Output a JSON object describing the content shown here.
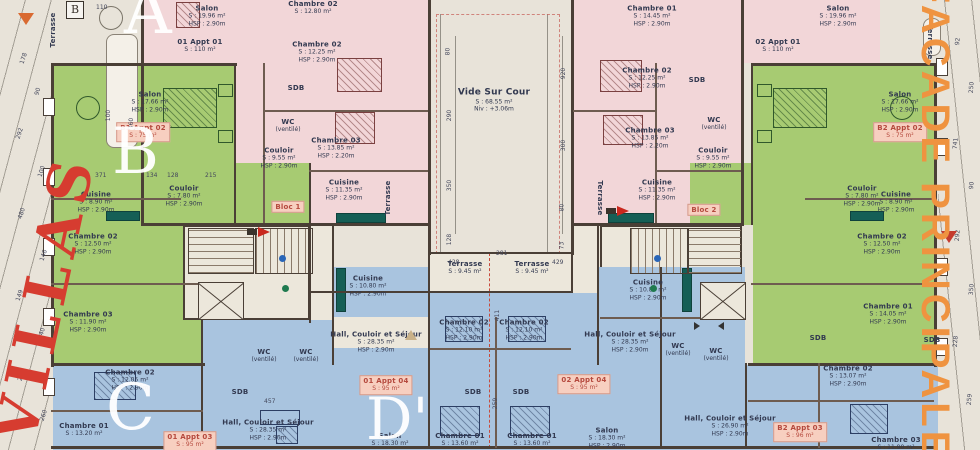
{
  "title": "Plan d'étage — Bloc 1 / Bloc 2",
  "margins": {
    "left_text": "VILLAS",
    "right_text": "FACADE PRINCIPALE",
    "corner_marker": "B"
  },
  "letters": {
    "a": "A",
    "b": "B",
    "c": "C",
    "d": "D'"
  },
  "colors": {
    "paper": "#e8e3d9",
    "pink_zone": "#f2d6d8",
    "green_zone": "#a7cb72",
    "blue_zone": "#a9c4df",
    "cream_zone": "#ece7db",
    "wall": "#4a3f36",
    "villas_red": "#d63c30",
    "facade_orange": "#ef9340",
    "apartment_label_bg": "#f7cfc0",
    "apartment_label_text": "#b5493d"
  },
  "rooms": [
    {
      "label": "Salon",
      "sub1": "S : 19.96 m²",
      "sub2": "HSP : 2.90m",
      "x": 207,
      "y": 16
    },
    {
      "label": "01 Appt 01",
      "sub1": "S : 110 m²",
      "x": 200,
      "y": 46
    },
    {
      "label": "Chambre 02",
      "sub1": "S : 12.80 m²",
      "x": 313,
      "y": 8
    },
    {
      "label": "Chambre 02",
      "sub1": "S : 12.25 m²",
      "sub2": "HSP : 2.90m",
      "x": 317,
      "y": 52
    },
    {
      "label": "SDB",
      "x": 296,
      "y": 88
    },
    {
      "label": "WC",
      "sub1": "(ventilé)",
      "x": 288,
      "y": 126
    },
    {
      "label": "Couloir",
      "sub1": "S : 9.55 m²",
      "sub2": "HSP : 2.90m",
      "x": 279,
      "y": 158
    },
    {
      "label": "Chambre 03",
      "sub1": "S : 13.85 m²",
      "sub2": "HSP : 2.20m",
      "x": 336,
      "y": 148
    },
    {
      "label": "Cuisine",
      "sub1": "S : 11.35 m²",
      "sub2": "HSP : 2.90m",
      "x": 344,
      "y": 190
    },
    {
      "label": "Vide Sur Cour",
      "sub1": "S : 68.55 m²",
      "sub2": "Niv : +3.06m",
      "x": 494,
      "y": 100,
      "lg": true
    },
    {
      "label": "Chambre 01",
      "sub1": "S : 14.45 m²",
      "sub2": "HSP : 2.90m",
      "x": 652,
      "y": 16
    },
    {
      "label": "Salon",
      "sub1": "S : 19.96 m²",
      "sub2": "HSP : 2.90m",
      "x": 838,
      "y": 16
    },
    {
      "label": "02 Appt 01",
      "sub1": "S : 110 m²",
      "x": 778,
      "y": 46
    },
    {
      "label": "Chambre 02",
      "sub1": "S : 12.25 m²",
      "sub2": "HSP : 2.90m",
      "x": 647,
      "y": 78
    },
    {
      "label": "SDB",
      "x": 697,
      "y": 80
    },
    {
      "label": "Chambre 03",
      "sub1": "S : 13.85 m²",
      "sub2": "HSP : 2.20m",
      "x": 650,
      "y": 138
    },
    {
      "label": "WC",
      "sub1": "(ventilé)",
      "x": 714,
      "y": 124
    },
    {
      "label": "Couloir",
      "sub1": "S : 9.55 m²",
      "sub2": "HSP : 2.90m",
      "x": 713,
      "y": 158
    },
    {
      "label": "Cuisine",
      "sub1": "S : 11.35 m²",
      "sub2": "HSP : 2.90m",
      "x": 657,
      "y": 190
    },
    {
      "label": "Salon",
      "sub1": "S : 17.66 m²",
      "sub2": "HSP : 2.90m",
      "x": 150,
      "y": 102
    },
    {
      "label": "B1 Appt 02",
      "sub1": "S : 75 m²",
      "x": 143,
      "y": 132,
      "box": true
    },
    {
      "label": "Couloir",
      "sub1": "S : 7.80 m²",
      "sub2": "HSP : 2.90m",
      "x": 184,
      "y": 196
    },
    {
      "label": "Cuisine",
      "sub1": "S : 8.90 m²",
      "sub2": "HSP : 2.90m",
      "x": 96,
      "y": 202
    },
    {
      "label": "Chambre 02",
      "sub1": "S : 12.50 m²",
      "sub2": "HSP : 2.90m",
      "x": 93,
      "y": 244
    },
    {
      "label": "Chambre 03",
      "sub1": "S : 11.90 m²",
      "sub2": "HSP : 2.90m",
      "x": 88,
      "y": 322
    },
    {
      "label": "Salon",
      "sub1": "S : 17.66 m²",
      "sub2": "HSP : 2.90m",
      "x": 900,
      "y": 102
    },
    {
      "label": "B2 Appt 02",
      "sub1": "S : 75 m²",
      "x": 900,
      "y": 132,
      "box": true
    },
    {
      "label": "Couloir",
      "sub1": "S : 7.80 m²",
      "sub2": "HSP : 2.90m",
      "x": 862,
      "y": 196
    },
    {
      "label": "Cuisine",
      "sub1": "S : 8.90 m²",
      "sub2": "HSP : 2.90m",
      "x": 896,
      "y": 202
    },
    {
      "label": "Chambre 02",
      "sub1": "S : 12.50 m²",
      "sub2": "HSP : 2.90m",
      "x": 882,
      "y": 244
    },
    {
      "label": "Chambre 01",
      "sub1": "S : 14.05 m²",
      "sub2": "HSP : 2.90m",
      "x": 888,
      "y": 314
    },
    {
      "label": "Chambre 02",
      "sub1": "S : 12.05 m²",
      "sub2": "HSP : 2.90m",
      "x": 130,
      "y": 380
    },
    {
      "label": "Chambre 01",
      "sub1": "S : 13.20 m²",
      "x": 84,
      "y": 430
    },
    {
      "label": "SDB",
      "x": 240,
      "y": 392
    },
    {
      "label": "Hall, Couloir et Séjour",
      "sub1": "S : 28.35 m²",
      "sub2": "HSP : 2.90m",
      "x": 268,
      "y": 430
    },
    {
      "label": "01 Appt 03",
      "sub1": "S : 95 m²",
      "x": 190,
      "y": 441,
      "box": true
    },
    {
      "label": "WC",
      "sub1": "(ventilé)",
      "x": 264,
      "y": 356
    },
    {
      "label": "WC",
      "sub1": "(ventilé)",
      "x": 306,
      "y": 356
    },
    {
      "label": "Cuisine",
      "sub1": "S : 10.80 m²",
      "sub2": "HSP : 2.90m",
      "x": 368,
      "y": 286
    },
    {
      "label": "Hall, Couloir et Séjour",
      "sub1": "S : 28.35 m²",
      "sub2": "HSP : 2.90m",
      "x": 376,
      "y": 342
    },
    {
      "label": "01 Appt 04",
      "sub1": "S : 95 m²",
      "x": 386,
      "y": 385,
      "box": true
    },
    {
      "label": "Terrasse",
      "sub1": "S : 9.45 m²",
      "x": 465,
      "y": 268
    },
    {
      "label": "Terrasse",
      "sub1": "S : 9.45 m²",
      "x": 532,
      "y": 268
    },
    {
      "label": "Chambre 02",
      "sub1": "S : 12.10 m²",
      "sub2": "HSP : 2.90m",
      "x": 464,
      "y": 330
    },
    {
      "label": "Chambre 02",
      "sub1": "S : 12.10 m²",
      "sub2": "HSP : 2.90m",
      "x": 524,
      "y": 330
    },
    {
      "label": "SDB",
      "x": 473,
      "y": 392
    },
    {
      "label": "SDB",
      "x": 521,
      "y": 392
    },
    {
      "label": "Chambre 01",
      "sub1": "S : 13.60 m²",
      "x": 460,
      "y": 440
    },
    {
      "label": "Chambre 01",
      "sub1": "S : 13.60 m²",
      "x": 532,
      "y": 440
    },
    {
      "label": "Salon",
      "sub1": "S : 18.30 m²",
      "x": 390,
      "y": 440
    },
    {
      "label": "Salon",
      "sub1": "S : 18.30 m²",
      "sub2": "HSP : 2.90m",
      "x": 607,
      "y": 438
    },
    {
      "label": "Cuisine",
      "sub1": "S : 10.80 m²",
      "sub2": "HSP : 2.90m",
      "x": 648,
      "y": 290
    },
    {
      "label": "Hall, Couloir et Séjour",
      "sub1": "S : 28.35 m²",
      "sub2": "HSP : 2.90m",
      "x": 630,
      "y": 342
    },
    {
      "label": "02 Appt 04",
      "sub1": "S : 95 m²",
      "x": 584,
      "y": 384,
      "box": true
    },
    {
      "label": "WC",
      "sub1": "(ventilé)",
      "x": 678,
      "y": 350
    },
    {
      "label": "WC",
      "sub1": "(ventilé)",
      "x": 716,
      "y": 355
    },
    {
      "label": "Hall, Couloir et Séjour",
      "sub1": "S : 26.90 m²",
      "sub2": "HSP : 2.90m",
      "x": 730,
      "y": 426
    },
    {
      "label": "B2 Appt 03",
      "sub1": "S : 96 m²",
      "x": 800,
      "y": 432,
      "box": true
    },
    {
      "label": "Chambre 02",
      "sub1": "S : 13.07 m²",
      "sub2": "HSP : 2.90m",
      "x": 848,
      "y": 376
    },
    {
      "label": "Chambre 03",
      "sub1": "S : 11.90 m²",
      "x": 896,
      "y": 444
    },
    {
      "label": "SDB",
      "x": 818,
      "y": 338
    },
    {
      "label": "SDB",
      "x": 932,
      "y": 340
    },
    {
      "label": "Bloc 1",
      "x": 288,
      "y": 207,
      "box": true
    },
    {
      "label": "Bloc 2",
      "x": 704,
      "y": 210,
      "box": true
    },
    {
      "label": "Terrasse",
      "x": 53,
      "y": 30,
      "rot": -90
    },
    {
      "label": "Terrasse",
      "x": 388,
      "y": 198,
      "rot": -90
    },
    {
      "label": "Terrasse",
      "x": 600,
      "y": 198,
      "rot": 90
    },
    {
      "label": "Terrasse",
      "x": 930,
      "y": 42,
      "rot": 90
    }
  ],
  "dims": [
    {
      "v": "178",
      "x": 18,
      "y": 55,
      "r": -72
    },
    {
      "v": "90",
      "x": 34,
      "y": 88,
      "r": -72
    },
    {
      "v": "292",
      "x": 14,
      "y": 130,
      "r": -72
    },
    {
      "v": "100",
      "x": 36,
      "y": 168,
      "r": -72
    },
    {
      "v": "480",
      "x": 16,
      "y": 210,
      "r": -72
    },
    {
      "v": "146",
      "x": 38,
      "y": 252,
      "r": -72
    },
    {
      "v": "149",
      "x": 14,
      "y": 292,
      "r": -72
    },
    {
      "v": "140",
      "x": 36,
      "y": 330,
      "r": -72
    },
    {
      "v": "248",
      "x": 16,
      "y": 372,
      "r": -72
    },
    {
      "v": "260",
      "x": 38,
      "y": 412,
      "r": -72
    },
    {
      "v": "371",
      "x": 95,
      "y": 172,
      "r": 0
    },
    {
      "v": "134",
      "x": 146,
      "y": 172,
      "r": 0
    },
    {
      "v": "128",
      "x": 167,
      "y": 172,
      "r": 0
    },
    {
      "v": "215",
      "x": 205,
      "y": 172,
      "r": 0
    },
    {
      "v": "360",
      "x": 126,
      "y": 120,
      "r": -90
    },
    {
      "v": "100",
      "x": 103,
      "y": 112,
      "r": -90
    },
    {
      "v": "110",
      "x": 96,
      "y": 4,
      "r": 0
    },
    {
      "v": "80",
      "x": 444,
      "y": 48,
      "r": -90
    },
    {
      "v": "290",
      "x": 444,
      "y": 112,
      "r": -90
    },
    {
      "v": "350",
      "x": 444,
      "y": 182,
      "r": -90
    },
    {
      "v": "128",
      "x": 444,
      "y": 236,
      "r": -90
    },
    {
      "v": "920",
      "x": 558,
      "y": 70,
      "r": -90
    },
    {
      "v": "300",
      "x": 558,
      "y": 142,
      "r": -90
    },
    {
      "v": "80",
      "x": 558,
      "y": 204,
      "r": -90
    },
    {
      "v": "73",
      "x": 558,
      "y": 242,
      "r": -90
    },
    {
      "v": "428",
      "x": 448,
      "y": 259,
      "r": 0
    },
    {
      "v": "429",
      "x": 552,
      "y": 259,
      "r": 0
    },
    {
      "v": "281",
      "x": 496,
      "y": 250,
      "r": 0
    },
    {
      "v": "457",
      "x": 264,
      "y": 398,
      "r": 0
    },
    {
      "v": "411",
      "x": 492,
      "y": 312,
      "r": -90
    },
    {
      "v": "259",
      "x": 490,
      "y": 400,
      "r": -90
    },
    {
      "v": "92",
      "x": 954,
      "y": 38,
      "r": -85
    },
    {
      "v": "250",
      "x": 966,
      "y": 84,
      "r": -85
    },
    {
      "v": "741",
      "x": 950,
      "y": 140,
      "r": -85
    },
    {
      "v": "90",
      "x": 968,
      "y": 182,
      "r": -85
    },
    {
      "v": "292",
      "x": 952,
      "y": 232,
      "r": -85
    },
    {
      "v": "350",
      "x": 966,
      "y": 286,
      "r": -85
    },
    {
      "v": "228",
      "x": 950,
      "y": 338,
      "r": -85
    },
    {
      "v": "259",
      "x": 964,
      "y": 396,
      "r": -85
    }
  ]
}
